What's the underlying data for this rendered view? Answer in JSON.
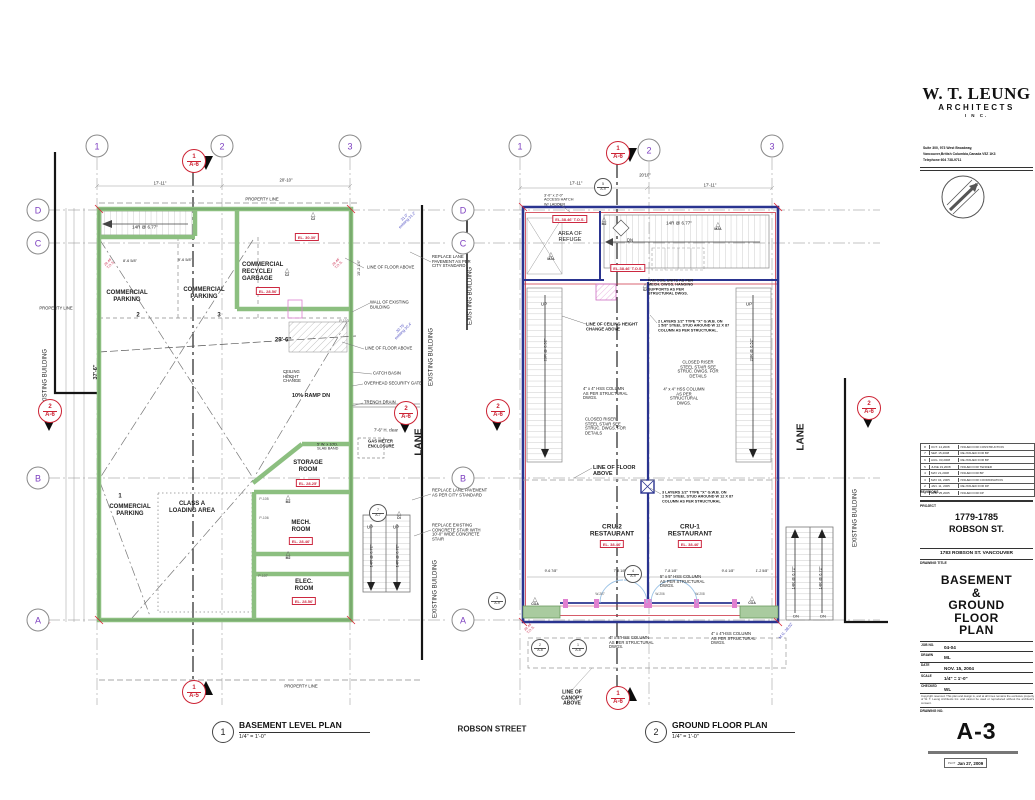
{
  "title_block": {
    "firm_name": "W. T. LEUNG",
    "firm_type": "ARCHITECTS",
    "firm_inc": "I N C.",
    "address_lines": [
      "Suite 300, 973 West Broadway,",
      "Vancouver,British Columbia,Canada  V5Z 1K3",
      "Telephone 604  738-9711"
    ],
    "revisions_label": "REVISIONS",
    "revisions": [
      {
        "no": "8",
        "date": "OCT. 14,2008",
        "note": "ISSUED FOR CONSTRUCTION"
      },
      {
        "no": "7",
        "date": "SEP. 15,2008",
        "note": "RE-ISSUED FOR BP"
      },
      {
        "no": "6",
        "date": "AUG. 03,2008",
        "note": "RE-ISSUED FOR BP"
      },
      {
        "no": "5",
        "date": "JUNE 19,2008",
        "note": "ISSUED FOR TENDER"
      },
      {
        "no": "4",
        "date": "MAY 21,2008",
        "note": "ISSUED FOR BP"
      },
      {
        "no": "3",
        "date": "MAY 04, 2005",
        "note": "ISSUED FOR COORDINATION"
      },
      {
        "no": "2",
        "date": "JAN. 11, 2005",
        "note": "RE-ISSUED FOR DP"
      },
      {
        "no": "1",
        "date": "APR. 25,2005",
        "note": "ISSUED FOR DP"
      }
    ],
    "project_label": "PROJECT",
    "project_name": "1779-1785\nROBSON ST.",
    "project_address": "1783 ROBSON ST. VANCOUVER",
    "drawing_title_label": "DRAWING TITLE",
    "drawing_title": "BASEMENT\n&\nGROUND\nFLOOR\nPLAN",
    "fields": [
      {
        "label": "JOB NO.",
        "value": "04-04"
      },
      {
        "label": "DRAWN",
        "value": "ML"
      },
      {
        "label": "DATE",
        "value": "NOV. 15, 2004"
      },
      {
        "label": "SCALE",
        "value": "1/4\" = 1'-0\""
      },
      {
        "label": "CHECKED",
        "value": "WL"
      }
    ],
    "copyright": "Copyright reserved. This plan and design is, and at all times remains the exclusive property of W. T. Leung Architects Inc. and cannot be used or reproduced without the architect's consent.",
    "drawing_no_label": "DRAWING NO.",
    "drawing_no": "A-3",
    "plot_prefix": "PLOT",
    "plot_date": "Jan 27, 2009"
  },
  "captions": {
    "plans": [
      {
        "no": "1",
        "title": "BASEMENT LEVEL PLAN",
        "scale": "1/4\" = 1'-0\"",
        "x": 212,
        "y": 720
      },
      {
        "no": "2",
        "title": "GROUND FLOOR PLAN",
        "scale": "1/4\" = 1'-0\"",
        "x": 645,
        "y": 720
      }
    ]
  },
  "bubbles": [
    {
      "l": "1",
      "x": 97,
      "y": 146
    },
    {
      "l": "2",
      "x": 222,
      "y": 146
    },
    {
      "l": "3",
      "x": 350,
      "y": 146
    },
    {
      "l": "D",
      "x": 38,
      "y": 210
    },
    {
      "l": "C",
      "x": 38,
      "y": 243
    },
    {
      "l": "B",
      "x": 38,
      "y": 478
    },
    {
      "l": "A",
      "x": 38,
      "y": 620
    },
    {
      "l": "1",
      "x": 520,
      "y": 146
    },
    {
      "l": "2",
      "x": 649,
      "y": 150
    },
    {
      "l": "3",
      "x": 772,
      "y": 146
    },
    {
      "l": "D",
      "x": 463,
      "y": 210
    },
    {
      "l": "C",
      "x": 463,
      "y": 243
    },
    {
      "l": "B",
      "x": 463,
      "y": 478
    },
    {
      "l": "A",
      "x": 463,
      "y": 620
    }
  ],
  "section_markers": [
    {
      "n": "1",
      "s": "A-6",
      "x": 193,
      "y": 160,
      "tx": 13,
      "ty": 3,
      "rot": 90
    },
    {
      "n": "1",
      "s": "A-5",
      "x": 193,
      "y": 691,
      "tx": 13,
      "ty": -3,
      "rot": -90
    },
    {
      "n": "2",
      "s": "A-6",
      "x": 49,
      "y": 410,
      "tx": 0,
      "ty": 14,
      "rot": 90
    },
    {
      "n": "2",
      "s": "A-6",
      "x": 405,
      "y": 412,
      "tx": 0,
      "ty": 14,
      "rot": 90
    },
    {
      "n": "2",
      "s": "A-6",
      "x": 497,
      "y": 410,
      "tx": 0,
      "ty": 14,
      "rot": 90
    },
    {
      "n": "2",
      "s": "A-6",
      "x": 868,
      "y": 407,
      "tx": 0,
      "ty": 14,
      "rot": 90
    },
    {
      "n": "1",
      "s": "A-6",
      "x": 617,
      "y": 152,
      "tx": 13,
      "ty": 3,
      "rot": 90
    },
    {
      "n": "1",
      "s": "A-6",
      "x": 617,
      "y": 697,
      "tx": 13,
      "ty": -3,
      "rot": -90
    }
  ],
  "detail_circles": [
    {
      "n": "4",
      "s": "A-9",
      "x": 633,
      "y": 574
    },
    {
      "n": "3",
      "s": "A-9",
      "x": 497,
      "y": 601
    },
    {
      "n": "7",
      "s": "A-7",
      "x": 378,
      "y": 513
    },
    {
      "n": "5",
      "s": "A-9",
      "x": 603,
      "y": 187
    },
    {
      "n": "2",
      "s": "A-8",
      "x": 540,
      "y": 648
    },
    {
      "n": "1",
      "s": "A-8",
      "x": 578,
      "y": 648
    }
  ],
  "tri_glyph": "△",
  "tri_markers": [
    {
      "l": "C2",
      "x": 313,
      "y": 217
    },
    {
      "l": "C2",
      "x": 287,
      "y": 273
    },
    {
      "l": "M2",
      "x": 288,
      "y": 500
    },
    {
      "l": "M2",
      "x": 288,
      "y": 556
    },
    {
      "l": "M2",
      "x": 604,
      "y": 222
    },
    {
      "l": "M2A",
      "x": 718,
      "y": 227
    },
    {
      "l": "M2A",
      "x": 551,
      "y": 257
    },
    {
      "l": "S2",
      "x": 645,
      "y": 288
    },
    {
      "l": "COA",
      "x": 535,
      "y": 602
    },
    {
      "l": "COA",
      "x": 752,
      "y": 601
    },
    {
      "l": "DI",
      "x": 399,
      "y": 516
    }
  ],
  "el_boxes": [
    {
      "t": "EL. 28.56'",
      "x": 268,
      "y": 291
    },
    {
      "t": "EL. 30.30'",
      "x": 307,
      "y": 237
    },
    {
      "t": "EL. 28.25'",
      "x": 308,
      "y": 483
    },
    {
      "t": "EL. 28.46'",
      "x": 301,
      "y": 541
    },
    {
      "t": "EL. 28.56'",
      "x": 304,
      "y": 601
    },
    {
      "t": "EL.38.46' T.O.S.",
      "x": 570,
      "y": 219
    },
    {
      "t": "EL.38.46' T.O.S.",
      "x": 628,
      "y": 268
    },
    {
      "t": "EL. 38.46'",
      "x": 612,
      "y": 544
    },
    {
      "t": "EL. 38.46'",
      "x": 690,
      "y": 544
    }
  ],
  "labels": [
    {
      "t": "COMMERCIAL\nPARKING",
      "x": 127,
      "y": 297,
      "fs": 6,
      "b": 1
    },
    {
      "t": "2",
      "x": 138,
      "y": 316,
      "fs": 6,
      "b": 1
    },
    {
      "t": "COMMERCIAL\nPARKING",
      "x": 204,
      "y": 294,
      "fs": 6,
      "b": 1
    },
    {
      "t": "3",
      "x": 219,
      "y": 316,
      "fs": 6,
      "b": 1
    },
    {
      "t": "COMMERCIAL\nRECYCLE/\nGARBAGE",
      "x": 242,
      "y": 272,
      "fs": 6,
      "b": 1,
      "al": "l"
    },
    {
      "t": "14R @ 6.77\"",
      "x": 145,
      "y": 227,
      "fs": 4.5
    },
    {
      "t": "10% RAMP DN",
      "x": 311,
      "y": 396,
      "fs": 5.5,
      "b": 1
    },
    {
      "t": "CEILING\nHEIGHT\nCHANGE",
      "x": 283,
      "y": 377,
      "fs": 4.2,
      "al": "l"
    },
    {
      "t": "29'-6\"",
      "x": 283,
      "y": 341,
      "fs": 6,
      "b": 1
    },
    {
      "t": "37'-6\"",
      "x": 96,
      "y": 372,
      "fs": 5.5,
      "b": 1,
      "r": -90
    },
    {
      "t": "STORAGE\nROOM",
      "x": 308,
      "y": 467,
      "fs": 6,
      "b": 1
    },
    {
      "t": "1",
      "x": 120,
      "y": 497,
      "fs": 6,
      "b": 1
    },
    {
      "t": "COMMERCIAL\nPARKING",
      "x": 130,
      "y": 511,
      "fs": 6,
      "b": 1
    },
    {
      "t": "CLASS A\nLOADING AREA",
      "x": 192,
      "y": 508,
      "fs": 6,
      "b": 1
    },
    {
      "t": "MECH.\nROOM",
      "x": 301,
      "y": 527,
      "fs": 6,
      "b": 1
    },
    {
      "t": "ELEC.\nROOM",
      "x": 304,
      "y": 586,
      "fs": 6,
      "b": 1
    },
    {
      "t": "PROPERTY LINE",
      "x": 56,
      "y": 309,
      "fs": 4.2
    },
    {
      "t": "PROPERTY LINE",
      "x": 262,
      "y": 200,
      "fs": 4.2
    },
    {
      "t": "PROPERTY LINE",
      "x": 301,
      "y": 687,
      "fs": 4.2
    },
    {
      "t": "EXISTING BUILDING",
      "x": 46,
      "y": 378,
      "fs": 6,
      "r": -90
    },
    {
      "t": "EXISTING BUILDING",
      "x": 432,
      "y": 357,
      "fs": 6,
      "r": -90
    },
    {
      "t": "EXISTING BUILDING",
      "x": 471,
      "y": 296,
      "fs": 6,
      "r": -90
    },
    {
      "t": "EXISTING BUILDING",
      "x": 436,
      "y": 589,
      "fs": 6,
      "r": -90
    },
    {
      "t": "EXISTING BUILDING",
      "x": 856,
      "y": 518,
      "fs": 6,
      "r": -90
    },
    {
      "t": "LANE",
      "x": 419,
      "y": 442,
      "fs": 10,
      "b": 1,
      "r": -90
    },
    {
      "t": "LANE",
      "x": 801,
      "y": 437,
      "fs": 10,
      "b": 1,
      "r": -90
    },
    {
      "t": "LINE OF FLOOR ABOVE",
      "x": 367,
      "y": 268,
      "fs": 4.2,
      "al": "l"
    },
    {
      "t": "WALL OF EXISTING\nBUILDING",
      "x": 370,
      "y": 305,
      "fs": 4.2,
      "al": "l"
    },
    {
      "t": "LINE OF FLOOR ABOVE",
      "x": 365,
      "y": 349,
      "fs": 4.2,
      "al": "l"
    },
    {
      "t": "CATCH BASIN",
      "x": 373,
      "y": 374,
      "fs": 4.2,
      "al": "l"
    },
    {
      "t": "OVERHEAD SECURITY GATE",
      "x": 364,
      "y": 384,
      "fs": 4.2,
      "al": "l"
    },
    {
      "t": "TRENCH DRAIN",
      "x": 364,
      "y": 403,
      "fs": 4.2,
      "al": "l"
    },
    {
      "t": "REPLACE LANE\nPAVEMENT AS PER\nCITY STANDARD",
      "x": 432,
      "y": 262,
      "fs": 4.2,
      "al": "l"
    },
    {
      "t": "REPLACE LANE  PAVEMENT\nAS PER CITY STANDARD",
      "x": 432,
      "y": 493,
      "fs": 4.2,
      "al": "l"
    },
    {
      "t": "REPLACE EXISTING\nCONCRETE STAIR WITH\n10'-0\" WIDE CONCRETE\nSTAIR",
      "x": 432,
      "y": 533,
      "fs": 4.2,
      "al": "l"
    },
    {
      "t": "7'-6\" H. clear",
      "x": 374,
      "y": 431,
      "fs": 4.2,
      "al": "l"
    },
    {
      "t": "GAS METER\nENCLOSURE",
      "x": 368,
      "y": 444,
      "fs": 4.2,
      "b": 1,
      "al": "l"
    },
    {
      "t": "5' W. x 10'D.\nSLAB BAND",
      "x": 317,
      "y": 447,
      "fs": 3.8,
      "al": "l"
    },
    {
      "t": "UP",
      "x": 370,
      "y": 527,
      "fs": 4.5
    },
    {
      "t": "UP",
      "x": 396,
      "y": 527,
      "fs": 4.5
    },
    {
      "t": "14R @ 6.72\"",
      "x": 372,
      "y": 556,
      "fs": 4,
      "r": -90
    },
    {
      "t": "14R @ 6.72\"",
      "x": 398,
      "y": 556,
      "fs": 4,
      "r": -90
    },
    {
      "t": "17'-11\"",
      "x": 160,
      "y": 184,
      "fs": 4.2
    },
    {
      "t": "20'-10\"",
      "x": 286,
      "y": 181,
      "fs": 4.2
    },
    {
      "t": "8'-6 5/8\"",
      "x": 130,
      "y": 261,
      "fs": 3.8
    },
    {
      "t": "9'-6 5/8\"",
      "x": 185,
      "y": 260,
      "fs": 3.8
    },
    {
      "t": "15'-2 1/4\"",
      "x": 359,
      "y": 268,
      "fs": 3.8,
      "r": -90
    },
    {
      "t": "P-105",
      "x": 264,
      "y": 500,
      "fs": 3.5,
      "c": "#555"
    },
    {
      "t": "P-106",
      "x": 264,
      "y": 519,
      "fs": 3.5,
      "c": "#555"
    },
    {
      "t": "P-107",
      "x": 263,
      "y": 577,
      "fs": 3.5,
      "c": "#555"
    },
    {
      "t": "P-103",
      "x": 344,
      "y": 322,
      "fs": 3.5,
      "c": "#555"
    },
    {
      "t": "3'-0\" x 2'-0\"\nACCESS HATCH\nW/ LADDER",
      "x": 544,
      "y": 200,
      "fs": 3.8,
      "al": "l"
    },
    {
      "t": "AREA OF\nREFUGE",
      "x": 570,
      "y": 237,
      "fs": 5.5
    },
    {
      "t": "14R @ 6.77\"",
      "x": 679,
      "y": 223,
      "fs": 4.5
    },
    {
      "t": "DN",
      "x": 630,
      "y": 241,
      "fs": 4.2
    },
    {
      "t": "FAN COIL UNITS AS PER\nMECH. DWGS. HANGING\nSUPPORTS AS PER\nSTRUCTURAL DWGS.",
      "x": 648,
      "y": 287,
      "fs": 3.8,
      "b": 1,
      "al": "l"
    },
    {
      "t": "LINE OF CEILING HEIGHT\nCHANGE ABOVE",
      "x": 586,
      "y": 327,
      "fs": 4.2,
      "b": 1,
      "al": "l"
    },
    {
      "t": "2 LAYERS 1/2\" TYPE \"X\" G.W.B. ON\n1 5/8\" STEEL STUD AROUND W 12 X 87\nCOLUMN AS PER STRUCTURAL.",
      "x": 658,
      "y": 326,
      "fs": 3.8,
      "b": 1,
      "al": "l"
    },
    {
      "t": "CLOSED RISER\nSTEEL STAIR SEE\nSTRUC. DWGS. FOR\nDETAILS",
      "x": 698,
      "y": 370,
      "fs": 4.2
    },
    {
      "t": "4\" x 4\" HSS COLUMN\nAS PER STRUCTURAL\nDWGS.",
      "x": 583,
      "y": 394,
      "fs": 4.2,
      "al": "l"
    },
    {
      "t": "4\" x 4\" HSS COLUMN\nAS PER\nSTRUCTURAL\nDWGS.",
      "x": 684,
      "y": 397,
      "fs": 4.2
    },
    {
      "t": "CLOSED RISER\nSTEEL STAIR SEE\nSTRUC. DWGS. FOR\nDETAILS",
      "x": 585,
      "y": 427,
      "fs": 4.2,
      "al": "l"
    },
    {
      "t": "UP",
      "x": 544,
      "y": 304,
      "fs": 4.5
    },
    {
      "t": "UP",
      "x": 749,
      "y": 304,
      "fs": 4.5
    },
    {
      "t": "23R @ 6.52\"",
      "x": 546,
      "y": 350,
      "fs": 4,
      "r": -90
    },
    {
      "t": "23R @ 6.52\"",
      "x": 752,
      "y": 350,
      "fs": 4,
      "r": -90
    },
    {
      "t": "LINE OF FLOOR\nABOVE",
      "x": 593,
      "y": 471,
      "fs": 5.5,
      "b": 1,
      "al": "l"
    },
    {
      "t": "3 LAYERS 1/2\" TYPE \"X\" G.W.B. ON\n1 5/8\" STEEL STUD AROUND W 12 X 87\nCOLUMN AS PER STRUCTURAL",
      "x": 662,
      "y": 497,
      "fs": 3.8,
      "b": 1,
      "al": "l"
    },
    {
      "t": "CRU-2\nRESTAURANT",
      "x": 612,
      "y": 531,
      "fs": 6.5,
      "b": 1
    },
    {
      "t": "CRU-1\nRESTAURANT",
      "x": 690,
      "y": 531,
      "fs": 6.5,
      "b": 1
    },
    {
      "t": "5\" x 5\" HSS COLUMN\nAS PER STRUCTURAL\nDWGS.",
      "x": 660,
      "y": 582,
      "fs": 4.2,
      "al": "l"
    },
    {
      "t": "4\" x 4\"HSS COLUMN\nAS PER STRUCTURAL\nDWGS.",
      "x": 609,
      "y": 643,
      "fs": 4.2,
      "al": "l"
    },
    {
      "t": "4\" x 4\"HSS COLUMN\nAS PER STRUCTURAL\nDWGS.",
      "x": 711,
      "y": 639,
      "fs": 4.2,
      "al": "l"
    },
    {
      "t": "LINE OF\nCANOPY\nABOVE",
      "x": 572,
      "y": 699,
      "fs": 5,
      "b": 1
    },
    {
      "t": "DN",
      "x": 796,
      "y": 617,
      "fs": 4
    },
    {
      "t": "DN",
      "x": 823,
      "y": 617,
      "fs": 4
    },
    {
      "t": "14R @ 6.72\"",
      "x": 794,
      "y": 578,
      "fs": 4,
      "r": -90
    },
    {
      "t": "14R @ 6.72\"",
      "x": 821,
      "y": 578,
      "fs": 4,
      "r": -90
    },
    {
      "t": "17'-11\"",
      "x": 576,
      "y": 184,
      "fs": 4.2
    },
    {
      "t": "20'10\"",
      "x": 645,
      "y": 176,
      "fs": 4.2
    },
    {
      "t": "17'-11\"",
      "x": 710,
      "y": 186,
      "fs": 4.2
    },
    {
      "t": "9'-6 7/8\"",
      "x": 551,
      "y": 572,
      "fs": 3.5
    },
    {
      "t": "7'-8 1/8\"",
      "x": 620,
      "y": 572,
      "fs": 3.5
    },
    {
      "t": "7'-8 1/8\"",
      "x": 671,
      "y": 572,
      "fs": 3.5
    },
    {
      "t": "9'-6 1/8\"",
      "x": 728,
      "y": 572,
      "fs": 3.5
    },
    {
      "t": "1'-2 5/8\"",
      "x": 762,
      "y": 572,
      "fs": 3.5
    },
    {
      "t": "W-207",
      "x": 600,
      "y": 595,
      "fs": 3.2,
      "c": "#555"
    },
    {
      "t": "W-206",
      "x": 660,
      "y": 595,
      "fs": 3.2,
      "c": "#555"
    },
    {
      "t": "W-208",
      "x": 700,
      "y": 595,
      "fs": 3.2,
      "c": "#555"
    },
    {
      "t": "ROBSON  STREET",
      "x": 492,
      "y": 729,
      "fs": 8,
      "b": 1
    },
    {
      "t": "31.0'\nexisting 31.2'",
      "x": 406,
      "y": 219,
      "fs": 3.8,
      "c": "#4a4ac0",
      "r": -45
    },
    {
      "t": "30.75'\nexisting 30.4'",
      "x": 402,
      "y": 330,
      "fs": 3.8,
      "c": "#4a4ac0",
      "r": -45
    },
    {
      "t": "M.G. 38.02'",
      "x": 786,
      "y": 631,
      "fs": 3.8,
      "c": "#4a4ac0",
      "r": -50
    },
    {
      "t": "28.46'\nT.O.S.",
      "x": 110,
      "y": 264,
      "fs": 3.5,
      "c": "#cc3355",
      "r": -45
    },
    {
      "t": "28.46'\nT.O.S.",
      "x": 338,
      "y": 264,
      "fs": 3.5,
      "c": "#cc3355",
      "r": -45
    },
    {
      "t": "28.06'\nT.O.S.",
      "x": 46,
      "y": 624,
      "fs": 3.5,
      "c": "#cc3355",
      "r": -45
    },
    {
      "t": "38.46'\nT.O.S.",
      "x": 530,
      "y": 629,
      "fs": 3.5,
      "c": "#cc3355",
      "r": -45
    }
  ],
  "colors": {
    "wall_green": "#8cbf80",
    "wall_navy": "#2a3490",
    "accent_red": "#cc2840",
    "grid_gray": "#b0b0b0",
    "bubble_purple": "#7d3fc0"
  }
}
